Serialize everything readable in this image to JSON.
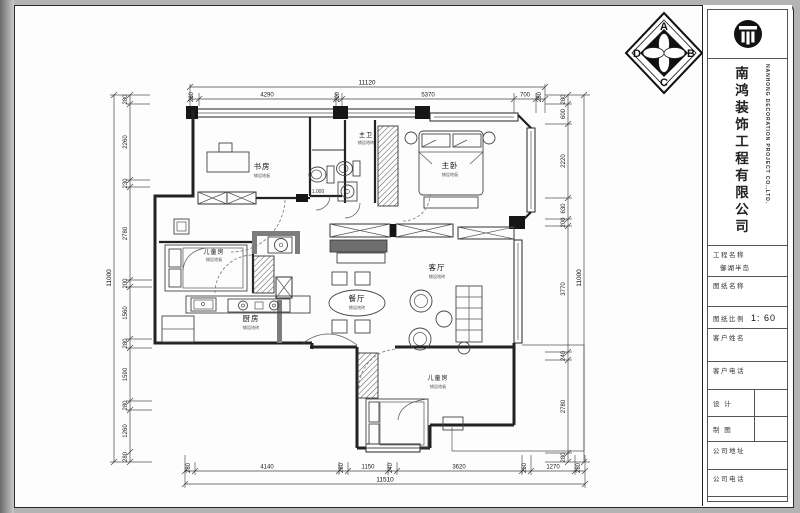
{
  "logo": {
    "letters": [
      "A",
      "B",
      "C",
      "D"
    ]
  },
  "title_block": {
    "company_cn": "南鸿装饰工程有限公司",
    "company_en": "NANHONG DECORATION PROJECT CO.,LTD.",
    "fields": {
      "project_label": "工程名称",
      "project_value": "御湖半岛",
      "drawing_label": "图纸名称",
      "scale_label": "图纸比例",
      "scale_value": "1: 60",
      "client_name_label": "客户姓名",
      "client_phone_label": "客户电话",
      "designer_label": "设 计",
      "drafter_label": "制 图",
      "company_address_label": "公司地址",
      "company_phone_label": "公司电话",
      "remarks_label": "备 注",
      "remarks_note": "(1) 本图文资料及解释权归本公司"
    }
  },
  "plan": {
    "rooms": [
      {
        "name": "书房",
        "finish": "铺设地板"
      },
      {
        "name": "主卫",
        "finish": "铺设地砖"
      },
      {
        "name": "主卧",
        "finish": "铺设地板"
      },
      {
        "name": "餐厅",
        "finish": "铺设地砖"
      },
      {
        "name": "客厅",
        "finish": "铺设地砖"
      },
      {
        "name": "厨房",
        "finish": "铺设地砖"
      },
      {
        "name": "儿童房",
        "finish": "铺设地板"
      },
      {
        "name": "儿童房",
        "finish": "铺设地板"
      }
    ],
    "elevation": "1.000"
  },
  "dims": {
    "top": {
      "total": "11120",
      "segments": [
        "280",
        "4290",
        "200",
        "5370",
        "700",
        "280"
      ]
    },
    "bottom": {
      "total": "11510",
      "segments": [
        "280",
        "4140",
        "280",
        "1150",
        "240",
        "3620",
        "250",
        "1270",
        "280"
      ]
    },
    "left": {
      "total": "11000",
      "segments": [
        "280",
        "2260",
        "230",
        "2780",
        "200",
        "1560",
        "280",
        "1590",
        "280",
        "1260",
        "280"
      ]
    },
    "right": {
      "total": "11000",
      "segments": [
        "280",
        "600",
        "2220",
        "630",
        "200",
        "3770",
        "240",
        "2780",
        "280"
      ]
    }
  }
}
